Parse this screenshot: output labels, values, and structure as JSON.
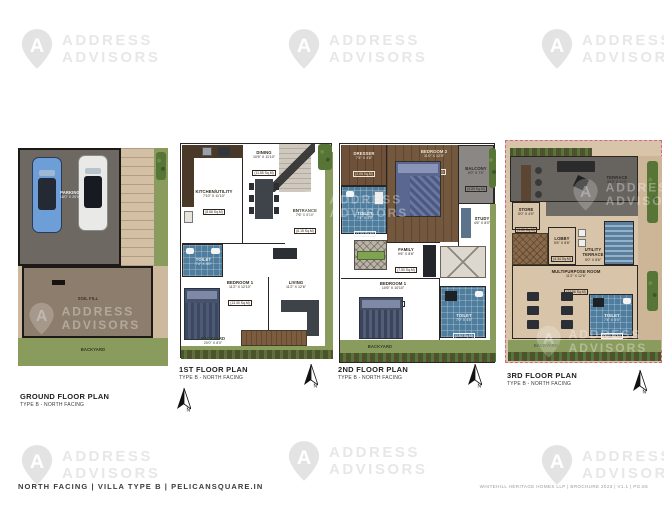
{
  "watermark": {
    "line1": "ADDRESS",
    "line2": "ADVISORS",
    "letter": "A"
  },
  "compass": {
    "label": "N"
  },
  "footer": {
    "left": "NORTH FACING | VILLA TYPE B | PELICANSQUARE.IN",
    "right": "WHITEHILL HERITAGE HOMES LLP | BROCHURE 2023 | V1.1 | PG.66"
  },
  "plans": {
    "ground": {
      "title": "GROUND FLOOR PLAN",
      "subtitle": "TYPE B - NORTH FACING",
      "rooms": {
        "parking": {
          "name": "PARKING",
          "dims": "18'0\" X 20'0\""
        },
        "soil_fill": {
          "name": "SOIL FILL"
        },
        "backyard": {
          "name": "BACKYARD"
        }
      }
    },
    "first": {
      "title": "1ST FLOOR PLAN",
      "subtitle": "TYPE B - NORTH FACING",
      "rooms": {
        "kitchen": {
          "name": "KITCHEN/UTILITY",
          "dims": "7'10\" X 11'10\"",
          "area": "(8.66 Sq.M)"
        },
        "dining": {
          "name": "DINING",
          "dims": "10'6\" X 11'10\"",
          "area": "(11.55 Sq.M)"
        },
        "entrance": {
          "name": "ENTRANCE",
          "dims": "7'6\" X 8'10\"",
          "area": "(6.15 Sq.M)"
        },
        "toilet": {
          "name": "TOILET",
          "dims": "7'4\" X 5'0\"",
          "area": "(3.40 Sq.M)"
        },
        "bedroom1": {
          "name": "BEDROOM 1",
          "dims": "11'2\" X 12'10\"",
          "area": "(13.30 Sq.M)"
        },
        "living": {
          "name": "LIVING",
          "dims": "11'2\" X 12'6\"",
          "area": "(12.96 Sq.M)"
        },
        "backyard": {
          "name": "BACKYARD",
          "dims": "20'0\" X 8'0\""
        }
      }
    },
    "second": {
      "title": "2ND FLOOR PLAN",
      "subtitle": "TYPE B - NORTH FACING",
      "rooms": {
        "dresser": {
          "name": "DRESSER",
          "dims": "7'4\" X 4'6\"",
          "area": "(3.06 Sq.M)"
        },
        "bedroom2": {
          "name": "BEDROOM 2",
          "dims": "11'0\" X 12'0\"",
          "area": "(12.26 Sq.M)"
        },
        "balcony": {
          "name": "BALCONY",
          "dims": "9'0\" X 7'0\"",
          "area": "(5.85 Sq.M)"
        },
        "toilet_upper": {
          "name": "TOILET",
          "dims": "7'4\" X 5'0\"",
          "area": "(3.40 Sq.M)"
        },
        "family": {
          "name": "FAMILY",
          "dims": "9'6\" X 8'6\"",
          "area": "(7.50 Sq.M)"
        },
        "study": {
          "name": "STUDY",
          "dims": "4'6\" X 8'0\""
        },
        "bedroom1": {
          "name": "BEDROOM 1",
          "dims": "10'6\" X 10'10\"",
          "area": "(10.56 Sq.M)"
        },
        "toilet_lower": {
          "name": "TOILET",
          "dims": "7'0\" X 4'6\"",
          "area": "(2.93 Sq.M)"
        },
        "backyard": {
          "name": "BACKYARD"
        }
      }
    },
    "third": {
      "title": "3RD FLOOR PLAN",
      "subtitle": "TYPE B - NORTH FACING",
      "rooms": {
        "terrace": {
          "name": "TERRACE",
          "dims": "24'2\" X 11'0\""
        },
        "store": {
          "name": "STORE",
          "dims": "5'0\" X 4'0\"",
          "area": "(1.86 Sq.M)"
        },
        "lobby": {
          "name": "LOBBY",
          "dims": "5'6\" X 8'6\"",
          "area": "(4.34 Sq.M)"
        },
        "utility_terrace": {
          "name": "UTILITY",
          "dims2": "TERRACE",
          "dims": "5'0\" X 8'6\""
        },
        "multipurpose": {
          "name": "MULTIPURPOSE ROOM",
          "dims": "11'2\" X 12'6\"",
          "area": "(12.96 Sq.M)"
        },
        "toilet": {
          "name": "TOILET",
          "dims": "7'4\" X 5'0\"",
          "area": "(3.40 Sq.M)"
        },
        "backyard": {
          "name": "BACKYARD"
        }
      }
    }
  },
  "colors": {
    "accent_pink": "#d4668c",
    "wall": "#2a2623",
    "floor_tan": "#dcc8ae",
    "tile_blue": "#4f7d9e",
    "wood": "#6e5138",
    "garden": "#8a9b5e",
    "hedge_green": "#44582a",
    "terrace_gray": "#67635f",
    "parking_gray": "#6e6862",
    "soil_brown": "#8d7d6c",
    "watermark_gray": "#e7e7e7",
    "car_blue": "#6d9ed8"
  }
}
